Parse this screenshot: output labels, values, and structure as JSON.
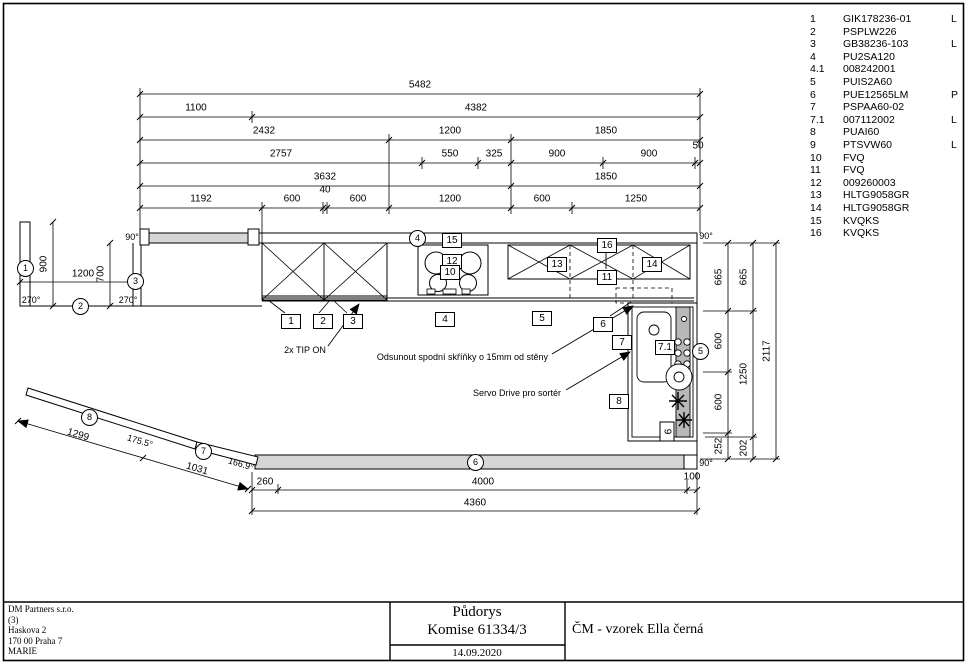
{
  "parts_list": {
    "rows": [
      {
        "num": "1",
        "code": "GIK178236-01",
        "flag": "L"
      },
      {
        "num": "2",
        "code": "PSPLW226",
        "flag": ""
      },
      {
        "num": "3",
        "code": "GB38236-103",
        "flag": "L"
      },
      {
        "num": "4",
        "code": "PU2SA120",
        "flag": ""
      },
      {
        "num": "4.1",
        "code": "008242001",
        "flag": ""
      },
      {
        "num": "5",
        "code": "PUIS2A60",
        "flag": ""
      },
      {
        "num": "6",
        "code": "PUE12565LM",
        "flag": "P"
      },
      {
        "num": "7",
        "code": "PSPAA60-02",
        "flag": ""
      },
      {
        "num": "7.1",
        "code": "007112002",
        "flag": "L"
      },
      {
        "num": "8",
        "code": "PUAI60",
        "flag": ""
      },
      {
        "num": "9",
        "code": "PTSVW60",
        "flag": "L"
      },
      {
        "num": "10",
        "code": "FVQ",
        "flag": ""
      },
      {
        "num": "11",
        "code": "FVQ",
        "flag": ""
      },
      {
        "num": "12",
        "code": "009260003",
        "flag": ""
      },
      {
        "num": "13",
        "code": "HLTG9058GR",
        "flag": ""
      },
      {
        "num": "14",
        "code": "HLTG9058GR",
        "flag": ""
      },
      {
        "num": "15",
        "code": "KVQKS",
        "flag": ""
      },
      {
        "num": "16",
        "code": "KVQKS",
        "flag": ""
      }
    ]
  },
  "dims": {
    "top_row1": [
      "5482"
    ],
    "top_row2": [
      "1100",
      "4382"
    ],
    "top_row3": [
      "2432",
      "1200",
      "1850"
    ],
    "top_row4": [
      "2757",
      "550",
      "325",
      "900",
      "900",
      "50"
    ],
    "top_row5": [
      "3632",
      "1850"
    ],
    "top_row6": [
      "1192",
      "600",
      "40",
      "600",
      "1200",
      "600",
      "1250"
    ],
    "left": [
      "900",
      "1200",
      "700"
    ],
    "right_col1": [
      "665",
      "600",
      "600",
      "252"
    ],
    "right_col2": [
      "665",
      "1250",
      "202"
    ],
    "right_col3": [
      "2117"
    ],
    "bottom_row1": [
      "260",
      "4000",
      "100"
    ],
    "bottom_row2": [
      "4360"
    ],
    "angled": [
      "1299",
      "1031"
    ]
  },
  "angles": {
    "topwall_left": "90°",
    "leftwall_bottom_left": "270°",
    "leftwall_bottom_right": "270°",
    "top_right": "90°",
    "bottom_right": "90°",
    "wall8": "175.5°",
    "wall7": "166.9°"
  },
  "plan": {
    "circle1": "1",
    "circle2": "2",
    "circle3": "3",
    "circle4": "4",
    "circle5": "5",
    "circle6": "6",
    "circle7": "7",
    "circle8": "8",
    "box1": "1",
    "box2": "2",
    "box3": "3",
    "box4": "4",
    "box5": "5",
    "box6": "6",
    "box7": "7",
    "box8": "8",
    "box9": "9",
    "box7_1": "7.1",
    "box10": "10",
    "box11": "11",
    "box12": "12",
    "box13": "13",
    "box14": "14",
    "box15": "15",
    "box16": "16"
  },
  "annotations": {
    "tip_on": "2x TIP ON",
    "move_cabinets": "Odsunout spodní skříňky o 15mm od stěny",
    "servo": "Servo Drive pro sortér"
  },
  "title_block": {
    "company_lines": [
      "DM Partners s.r.o.",
      "(3)",
      "Haskova 2",
      "170 00 Praha 7",
      "MARIE"
    ],
    "drawing_title": "Půdorys",
    "commission": "Komise 61334/3",
    "date": "14.09.2020",
    "project": "ČM - vzorek Ella černá"
  }
}
